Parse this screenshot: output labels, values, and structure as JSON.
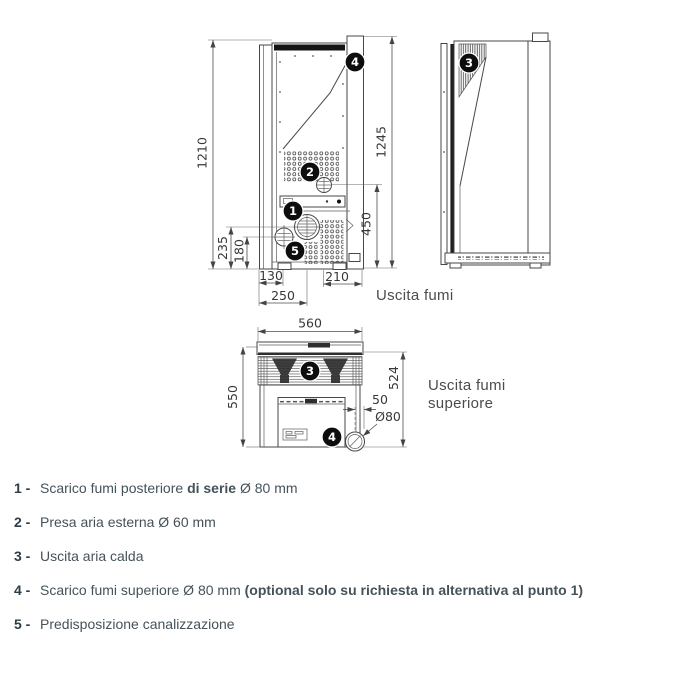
{
  "rear_view": {
    "dims": {
      "height_left": "1210",
      "height_right": "1245",
      "flue_height": "450",
      "dim_235": "235",
      "dim_180": "180",
      "dim_130": "130",
      "dim_250": "250",
      "dim_210": "210"
    },
    "callouts": {
      "c1": "1",
      "c2": "2",
      "c4": "4",
      "c5": "5"
    },
    "label": "Uscita fumi"
  },
  "side_view": {
    "callouts": {
      "c3": "3"
    }
  },
  "top_view": {
    "dims": {
      "width": "560",
      "depth_left": "550",
      "depth_right": "524",
      "offset": "50",
      "diameter": "Ø80"
    },
    "callouts": {
      "c3": "3",
      "c4": "4"
    },
    "label_line1": "Uscita fumi",
    "label_line2": "superiore"
  },
  "legend": {
    "items": [
      {
        "num": "1 -",
        "pre": "Scarico fumi posteriore ",
        "bold": "di serie",
        "post": " Ø 80 mm"
      },
      {
        "num": "2 -",
        "pre": "Presa aria esterna Ø 60 mm",
        "bold": "",
        "post": ""
      },
      {
        "num": "3 -",
        "pre": "Uscita aria calda",
        "bold": "",
        "post": ""
      },
      {
        "num": "4 -",
        "pre": "Scarico fumi superiore Ø 80 mm ",
        "bold": "(optional solo su richiesta in alternativa al punto 1)",
        "post": ""
      },
      {
        "num": "5 -",
        "pre": "Predisposizione canalizzazione",
        "bold": "",
        "post": ""
      }
    ]
  }
}
